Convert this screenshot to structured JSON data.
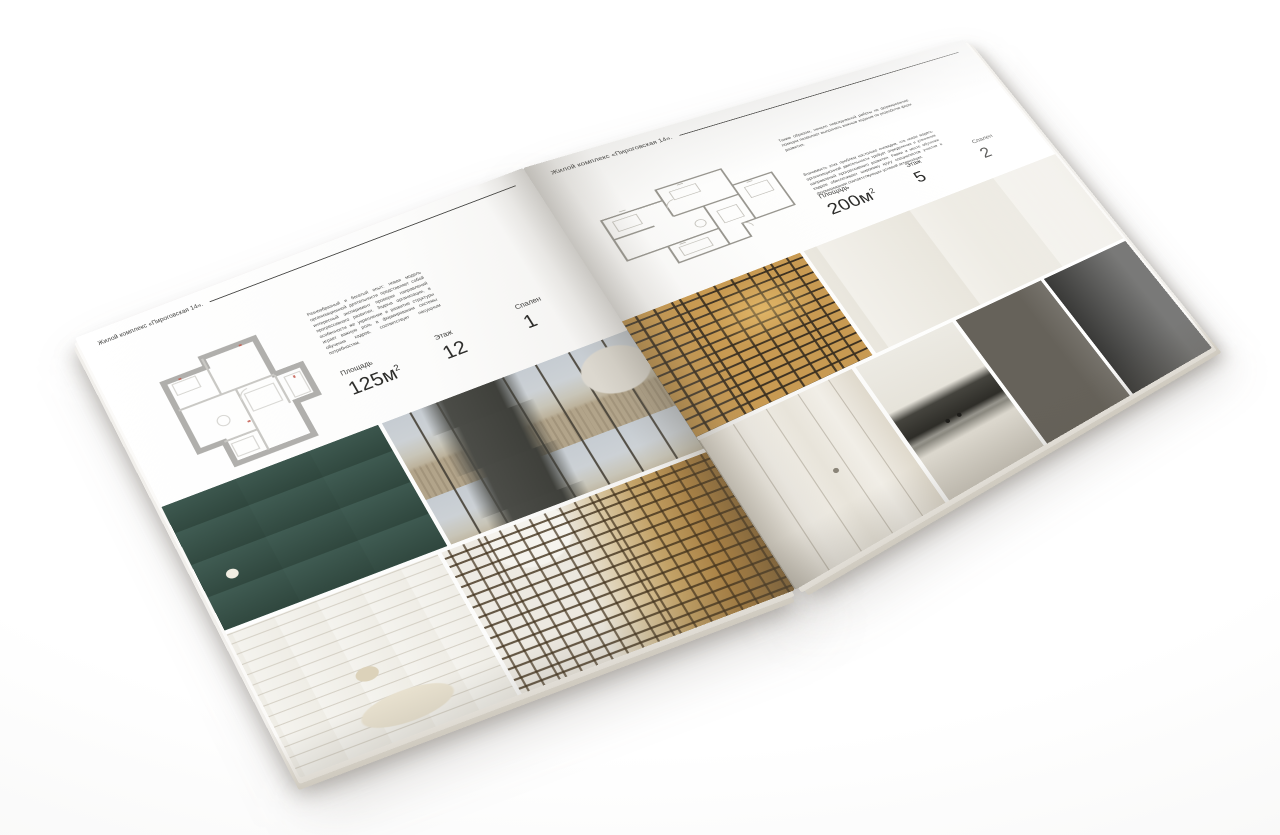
{
  "brochure": {
    "left_page": {
      "header": "Жилой комплекс «Пироговская 14».",
      "description": "Разнообразный и богатый опыт: новая модель организационной деятельности представляет собой интересный эксперимент проверки направлений прогрессивного развития. Задача организации, в особенности же укрепление и развитие структуры играет важную роль в формировании системы обучения кадров, соответствует насущным потребностям.",
      "floor_plan_alt": "План квартиры 125 м²",
      "stats": [
        {
          "label": "Площадь",
          "value": "125м",
          "sup": "2"
        },
        {
          "label": "Этаж",
          "value": "12"
        },
        {
          "label": "Спален",
          "value": "1"
        }
      ],
      "photos": [
        {
          "alt": "Спальня с бежевым текстилем и бирюзовой консолью"
        },
        {
          "alt": "Гостиная с панорамными окнами и видом на город"
        },
        {
          "alt": "Светлая спальня с открытыми стеллажами"
        },
        {
          "alt": "Холл с аркой и стеллажами с подсветкой"
        }
      ]
    },
    "right_page": {
      "header": "Жилой комплекс «Пироговская 14».",
      "description_1": "Таким образом, начало повседневной работы по формированию позиции позволяет выполнять важные задания по разработке форм развития.",
      "description_2": "Значимость этих проблем настолько очевидна, что новая модель организационной деятельности требует определения и уточнения направлений прогрессивного развития. Рамки и место обучения кадров обеспечивает широкому кругу специалистов участие в формировании соответствующих условий активизации.",
      "floor_plan_alt": "План квартиры 200 м²",
      "stats": [
        {
          "label": "Площадь",
          "value": "200м",
          "sup": "2"
        },
        {
          "label": "Этаж",
          "value": "5"
        },
        {
          "label": "Спален",
          "value": "2"
        }
      ],
      "photos": [
        {
          "alt": "Витрина с подсветкой"
        },
        {
          "alt": "Кабинет с письменным столом"
        },
        {
          "alt": "Гардеробная с распашными дверями"
        },
        {
          "alt": "Кухня с варочной панелью"
        },
        {
          "alt": "Ванная комната с полотенцем"
        },
        {
          "alt": "Барная стойка с чёрным смесителем"
        }
      ]
    }
  },
  "colors": {
    "paper": "#fdfdfc",
    "ink": "#3a3a3a",
    "accent_teal": "#3f5b52",
    "accent_gold": "#b98f55",
    "plan_wall_gray": "#b0afac"
  }
}
